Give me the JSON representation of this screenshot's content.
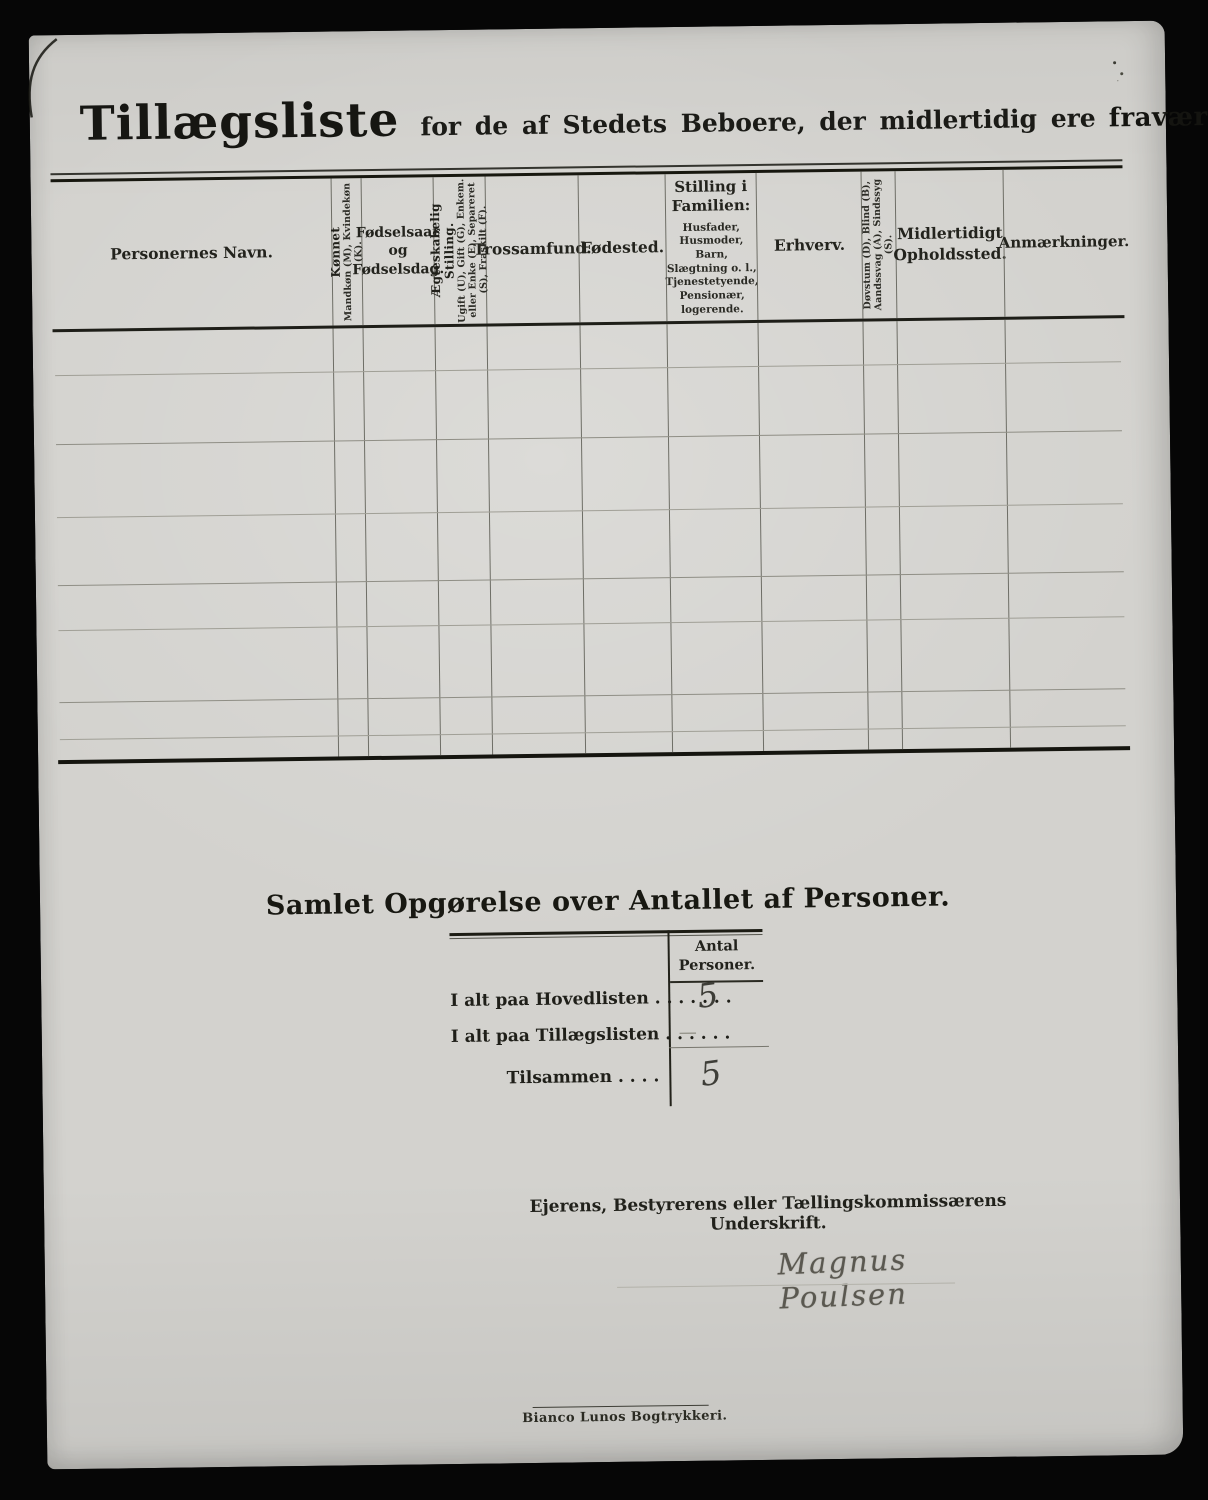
{
  "title": {
    "main": "Tillægsliste",
    "subtitle": "for de af Stedets Beboere, der midlertidig ere",
    "subtitle_emphasis": "fraværende."
  },
  "table": {
    "columns": [
      {
        "main": "Personernes Navn."
      },
      {
        "main": "Kønnet",
        "sub": "Mandkøn (M), Kvindekøn (K)."
      },
      {
        "main": "Fødselsaar og Fødselsdag."
      },
      {
        "main": "Ægteskabelig Stilling.",
        "sub": "Ugift (U), Gift (G), Enkem. eller Enke (E), Separeret (S), Fraskilt (F)."
      },
      {
        "main": "Trossamfund."
      },
      {
        "main": "Fødested."
      },
      {
        "main": "Stilling i Familien:",
        "sub": "Husfader, Husmoder, Barn, Slægtning o. l., Tjenestetyende, Pensionær, logerende."
      },
      {
        "main": "Erhverv."
      },
      {
        "main": "Døvstum (D), Blind (B), Aandssvag (A), Sindssyg (S)."
      },
      {
        "main": "Midlertidigt Opholdssted."
      },
      {
        "main": "Anmærkninger."
      }
    ],
    "rows": []
  },
  "summary": {
    "heading": "Samlet Opgørelse over Antallet af Personer.",
    "col_header": "Antal Personer.",
    "rows": [
      {
        "label": "I alt paa Hovedlisten . . . . . . .",
        "value": "5"
      },
      {
        "label": "I alt paa Tillægslisten  . . . . . .",
        "value": "—"
      },
      {
        "label": "Tilsammen . . . .",
        "value": "5"
      }
    ]
  },
  "signature": {
    "label": "Ejerens, Bestyrerens eller Tællingskommissærens Underskrift.",
    "name": "Magnus Poulsen"
  },
  "footer": {
    "printer": "Bianco Lunos Bogtrykkeri."
  },
  "colors": {
    "paper": "#d3d2ce",
    "background": "#060606",
    "ink": "#1a1a14",
    "handwriting": "#4a4a44"
  }
}
